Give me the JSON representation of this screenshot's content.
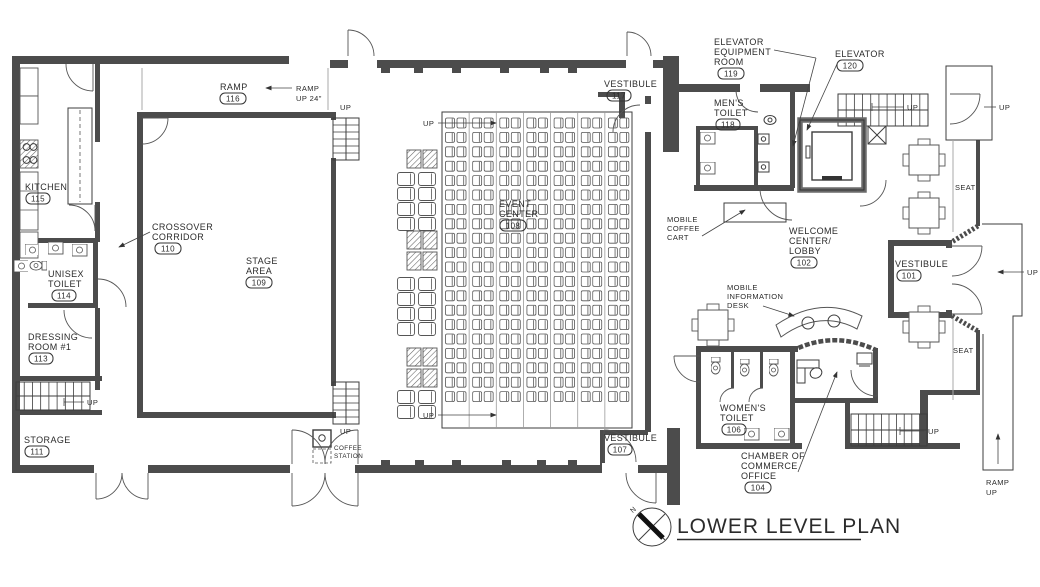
{
  "title": "LOWER LEVEL PLAN",
  "north_label": "N",
  "rooms": {
    "ramp": {
      "lines": [
        "RAMP"
      ],
      "number": "116"
    },
    "kitchen": {
      "lines": [
        "KITCHEN"
      ],
      "number": "115"
    },
    "crossover_corridor": {
      "lines": [
        "CROSSOVER",
        "CORRIDOR"
      ],
      "number": "110"
    },
    "unisex_toilet": {
      "lines": [
        "UNISEX",
        "TOILET"
      ],
      "number": "114"
    },
    "dressing_room_1": {
      "lines": [
        "DRESSING",
        "ROOM #1"
      ],
      "number": "113"
    },
    "storage": {
      "lines": [
        "STORAGE"
      ],
      "number": "111"
    },
    "stage_area": {
      "lines": [
        "STAGE",
        "AREA"
      ],
      "number": "109"
    },
    "event_center": {
      "lines": [
        "EVENT",
        "CENTER"
      ],
      "number": "108"
    },
    "vestibule_117": {
      "lines": [
        "VESTIBULE"
      ],
      "number": "117"
    },
    "elevator_equipment_room": {
      "lines": [
        "ELEVATOR",
        "EQUIPMENT",
        "ROOM"
      ],
      "number": "119"
    },
    "elevator": {
      "lines": [
        "ELEVATOR"
      ],
      "number": "120"
    },
    "mens_toilet": {
      "lines": [
        "MEN'S",
        "TOILET"
      ],
      "number": "118"
    },
    "welcome_center_lobby": {
      "lines": [
        "WELCOME",
        "CENTER/",
        "LOBBY"
      ],
      "number": "102"
    },
    "vestibule_101": {
      "lines": [
        "VESTIBULE"
      ],
      "number": "101"
    },
    "womens_toilet": {
      "lines": [
        "WOMEN'S",
        "TOILET"
      ],
      "number": "106"
    },
    "vestibule_107": {
      "lines": [
        "VESTIBULE"
      ],
      "number": "107"
    },
    "chamber_of_commerce_office": {
      "lines": [
        "CHAMBER OF",
        "COMMERCE",
        "OFFICE"
      ],
      "number": "104"
    }
  },
  "annotations": {
    "up": "UP",
    "ramp_up_24": {
      "lines": [
        "RAMP",
        "UP 24\""
      ]
    },
    "ramp_up": {
      "lines": [
        "RAMP",
        "UP"
      ]
    },
    "coffee_station": {
      "lines": [
        "COFFEE",
        "STATION"
      ]
    },
    "mobile_coffee_cart": {
      "lines": [
        "MOBILE",
        "COFFEE",
        "CART"
      ]
    },
    "mobile_information_desk": {
      "lines": [
        "MOBILE",
        "INFORMATION",
        "DESK"
      ]
    },
    "seat": "SEAT"
  },
  "seating": {
    "columns": 7,
    "rows": 20,
    "chairs_per_row": 2
  },
  "colors": {
    "line": "#3d3d3d",
    "wall": "#4c4c4c",
    "gray": "#a8a8a8",
    "background": "#ffffff"
  }
}
